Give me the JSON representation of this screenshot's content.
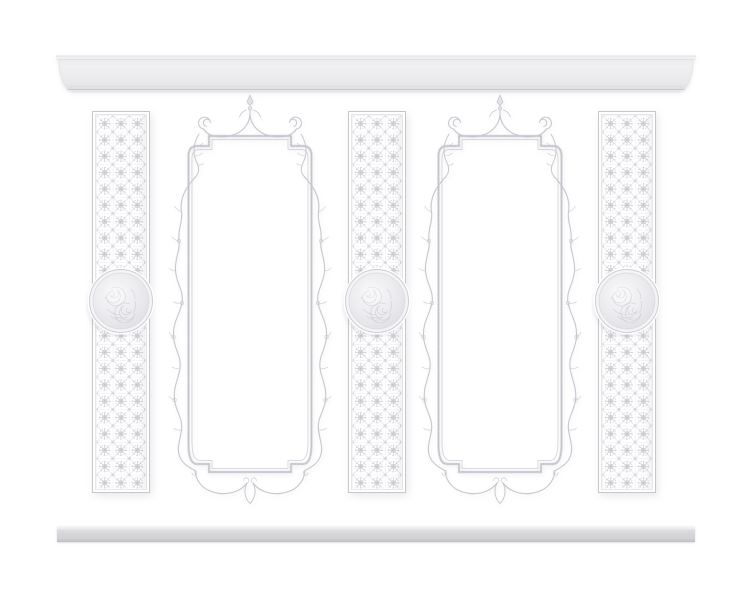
{
  "scene": {
    "label": "White classical wall moulding decor set, 3D render on white background",
    "background_color": "#ffffff"
  },
  "palette": {
    "plaster_highlight": "#f4f4f6",
    "plaster_face": "#ebebee",
    "plaster_shade": "#d7d7da",
    "outline_soft": "#cdced4",
    "outline_strong": "#bcbdc5",
    "baseboard_face": "#d6d6d9"
  },
  "elements": {
    "cornice": {
      "label": "crown cornice moulding",
      "count": 1
    },
    "baseboard": {
      "label": "baseboard moulding strip",
      "count": 1
    },
    "fretwork_panel": {
      "label": "geometric star fretwork pilaster panel",
      "count": 3
    },
    "medallion": {
      "label": "round floral relief medallion",
      "count": 3
    },
    "scroll_frame": {
      "label": "rococo scroll frame moulding",
      "count": 2
    }
  }
}
